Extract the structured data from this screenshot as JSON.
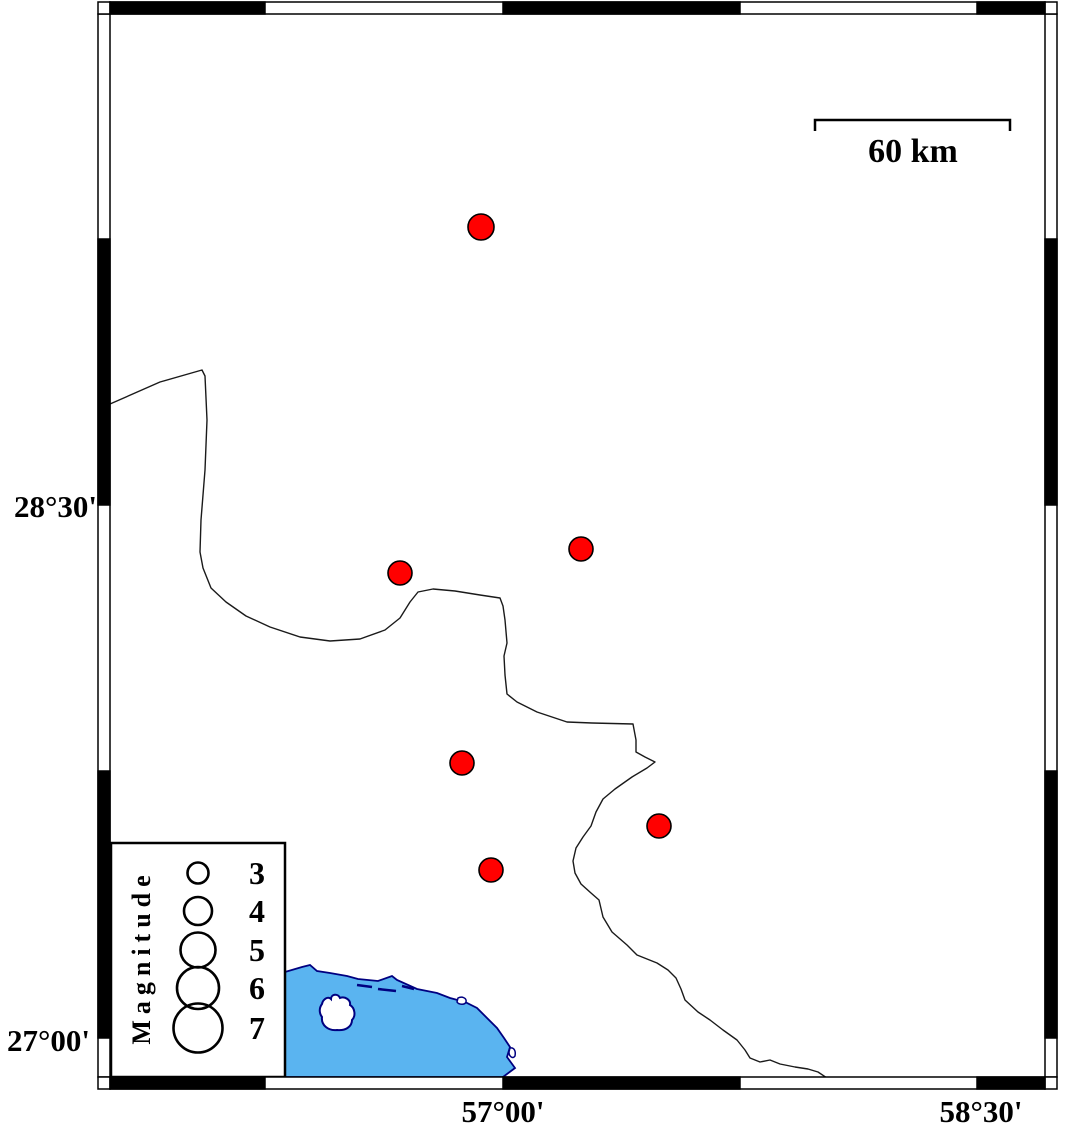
{
  "axis": {
    "left_top_label": "28°30'",
    "left_bottom_label": "27°00'",
    "bottom_left_label": "57°00'",
    "bottom_right_label": "58°30'"
  },
  "scalebar": {
    "label": "60 km"
  },
  "legend": {
    "title": "Magnitude",
    "entries": [
      {
        "label": "3",
        "cy": 873,
        "r": 10.5
      },
      {
        "label": "4",
        "cy": 911,
        "r": 14
      },
      {
        "label": "5",
        "cy": 950,
        "r": 17.5
      },
      {
        "label": "6",
        "cy": 988,
        "r": 21
      },
      {
        "label": "7",
        "cy": 1028,
        "r": 24.5
      }
    ]
  },
  "epicenters": [
    {
      "cx": 481,
      "cy": 227,
      "r": 13
    },
    {
      "cx": 581,
      "cy": 549,
      "r": 12
    },
    {
      "cx": 400,
      "cy": 573,
      "r": 12
    },
    {
      "cx": 462,
      "cy": 763,
      "r": 12
    },
    {
      "cx": 659,
      "cy": 826,
      "r": 12
    },
    {
      "cx": 491,
      "cy": 870,
      "r": 12
    }
  ],
  "colors": {
    "epicenter_fill": "#FF0000",
    "epicenter_stroke": "#000000",
    "sea_fill": "#5AB4F0",
    "coast_stroke": "#000080",
    "boundary_stroke": "#1a1a1a",
    "frame_black": "#000000",
    "frame_white": "#ffffff"
  },
  "geo": {
    "boundary_path": "M110,404 L160,382 L195,372 L202,370 L205,376 L207,420 L205,470 L201,520 L200,552 L203,568 L211,588 L226,602 L246,616 L270,627 L300,637 L330,641 L360,639 L385,630 L400,618 L410,602 L418,592 L433,589 L455,591 L480,595 L500,598 L503,606 L505,620 L507,643 L504,656 L505,675 L507,694 L517,702 L537,712 L567,722 L592,723 L633,724 L636,740 L636,752 L645,757 L655,762 L647,768 L632,777 L615,789 L603,799 L596,812 L591,826 L583,837 L576,848 L573,861 L575,873 L581,884 L591,893 L599,900 L603,917 L612,932 L627,945 L637,955 L657,963 L668,970 L676,978 L681,989 L685,1000 L698,1012 L710,1020 L723,1030 L737,1040 L745,1050 L750,1058 L760,1062 L770,1060 L780,1064 L795,1067 L808,1069 L818,1072 L830,1080",
    "coast_path": "M110,970 L285,972 L302,967 L310,965 L317,971 L330,973 L347,976 L358,979 L378,981 L392,976 L397,980 L417,989 L437,993 L450,998 L465,1002 L477,1008 L487,1018 L497,1028 L504,1038 L510,1047 L507,1057 L515,1068 L503,1077 L110,1077 Z",
    "island_path": "M322,1004 C323,999 328,996 331,999 C331,994 338,993 340,998 C345,996 351,1000 350,1005 C355,1008 356,1016 352,1020 C352,1027 345,1031 337,1030 C328,1031 321,1025 322,1017 C319,1013 319,1008 322,1004 Z",
    "reef_dash_1": "M357,985 L372,987",
    "reef_dash_2": "M378,989 L396,991",
    "reef_dash_3": "M402,986 L414,989",
    "islet_1": "M458,998 C462,996 467,998 466,1002 C465,1005 459,1005 457,1002 Z",
    "islet_2": "M510,1048 C514,1047 516,1051 515,1056 C513,1059 509,1057 509,1052 Z"
  }
}
